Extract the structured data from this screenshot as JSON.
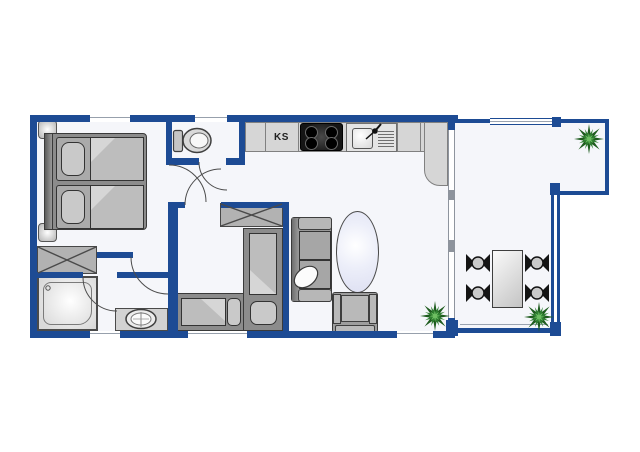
{
  "plan": {
    "type": "apartment-floor-plan",
    "kitchen": {
      "fridge_label": "KS"
    },
    "rooms": [
      {
        "name": "bedroom-double"
      },
      {
        "name": "wc"
      },
      {
        "name": "kitchen-living-open-plan"
      },
      {
        "name": "bedroom-twin"
      },
      {
        "name": "bathroom"
      },
      {
        "name": "hallway"
      },
      {
        "name": "terrace"
      }
    ],
    "furniture_icons": [
      "double-bed-icon",
      "nightstand-icon",
      "wardrobe-icon",
      "toilet-icon",
      "kitchen-counter-icon",
      "stove-icon",
      "sink-icon",
      "shower-icon",
      "washbasin-icon",
      "twin-bed-icon",
      "sofa-icon",
      "coffee-table-icon",
      "armchair-icon",
      "dining-table-icon",
      "dining-chair-icon",
      "plant-icon",
      "door-swing-icon",
      "window-icon"
    ]
  },
  "colors": {
    "wall_blue": "#1d4b94",
    "floor": "#f5f6fa",
    "counter_gray": "#d6d6d6",
    "furniture_dark": "#3a3a3a",
    "furniture_mid": "#a9a9a9",
    "oval_table_lavender": "#dddff2",
    "plant_dark_green": "#1e5c1e",
    "plant_mid_green": "#2f8132",
    "plant_light_green": "#6fbf63"
  }
}
